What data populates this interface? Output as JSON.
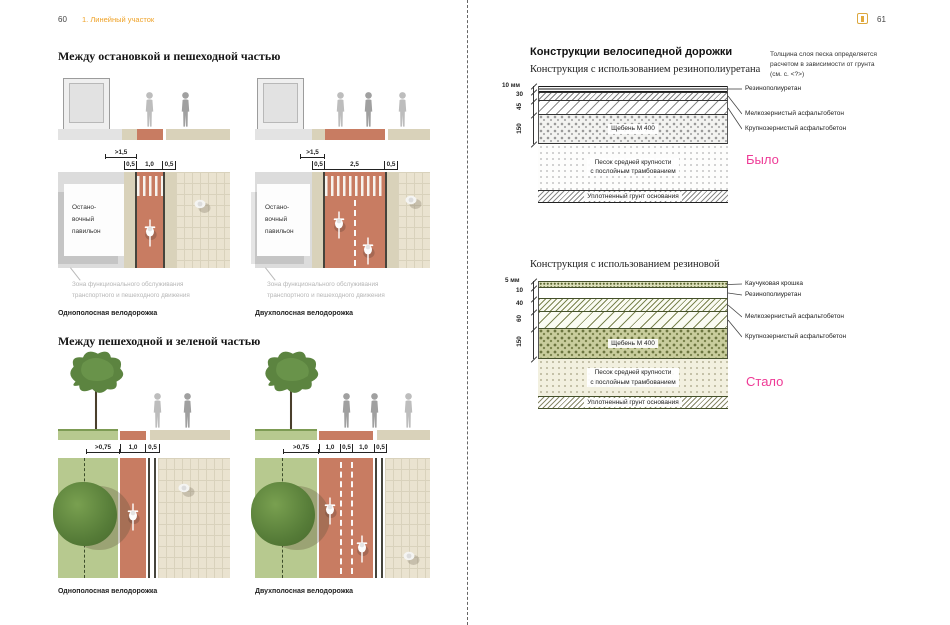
{
  "left_page": {
    "page_number": "60",
    "chapter_label": "1. Линейный участок",
    "sections": [
      {
        "title": "Между остановкой и пешеходной частью",
        "diagrams": [
          {
            "caption": "Однополосная велодорожка",
            "dim_offset": ">1,5",
            "dims": [
              "0,5",
              "1,0",
              "0,5"
            ],
            "pavilion": "Остано-\nвочный\nпавильон",
            "annotation": "Зона функционального обслуживания\nтранспортного и пешеходного движения"
          },
          {
            "caption": "Двухполосная велодорожка",
            "dim_offset": ">1,5",
            "dims": [
              "0,5",
              "2,5",
              "0,5"
            ],
            "pavilion": "Остано-\nвочный\nпавильон",
            "annotation": "Зона функционального обслуживания\nтранспортного и пешеходного движения"
          }
        ]
      },
      {
        "title": "Между пешеходной и зеленой частью",
        "diagrams": [
          {
            "caption": "Однополосная велодорожка",
            "dim_offset": ">0,75",
            "dims": [
              "1,0",
              "0,5"
            ]
          },
          {
            "caption": "Двухполосная велодорожка",
            "dim_offset": ">0,75",
            "dims": [
              "1,0",
              "0,5",
              "1,0",
              "0,5"
            ]
          }
        ]
      }
    ]
  },
  "right_page": {
    "page_number": "61",
    "title": "Конструкции велосипедной дорожки",
    "note": "Толщина слоя песка определяется\nрасчетом в зависимости от грунта\n(см. с. <?>)",
    "constructions": [
      {
        "subtitle": "Конструкция с использованием резинополиуретана",
        "dims": [
          "10 мм",
          "30",
          "45",
          "150"
        ],
        "layer_labels": [
          "Резинополиуретан",
          "Мелкозернистый асфальтобетон",
          "Крупнозернистый асфальтобетон"
        ],
        "rubble_label": "Щебень М 400",
        "sand_label": "Песок средней крупности\nс послойным трамбованием",
        "base_label": "Уплотненный грунт основания",
        "status": "Было"
      },
      {
        "subtitle": "Конструкция с использованием резиновой",
        "dims": [
          "5 мм",
          "10",
          "40",
          "60",
          "150"
        ],
        "layer_labels": [
          "Каучуковая крошка",
          "Резинополиуретан",
          "Мелкозернистый асфальтобетон",
          "Крупнозернистый асфальтобетон"
        ],
        "rubble_label": "Щебень М 400",
        "sand_label": "Песок средней крупности\nс послойным трамбованием",
        "base_label": "Уплотненный грунт основания",
        "status": "Стало"
      }
    ]
  },
  "colors": {
    "accent_orange": "#efa227",
    "status_pink": "#ee3a96",
    "bike_lane_red": "#c87c62",
    "green_strip": "#b7c98f",
    "paving_beige": "#eae3d0"
  }
}
